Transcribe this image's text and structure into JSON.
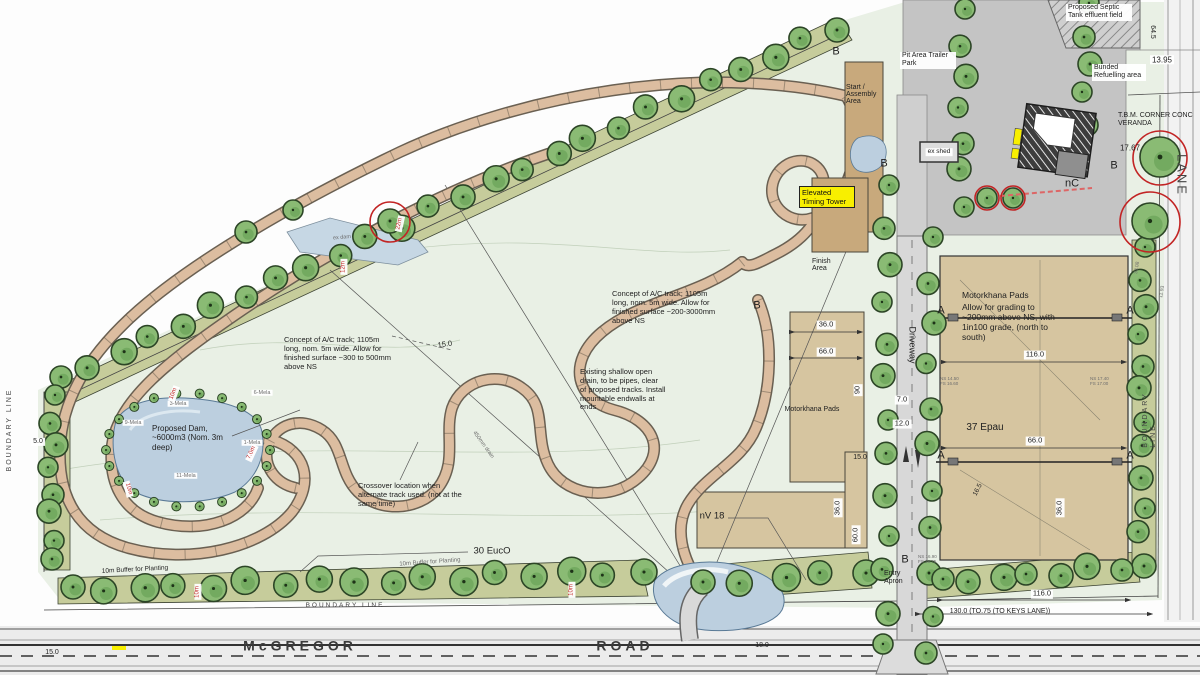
{
  "boxes": {
    "start": "Start / Assembly Area",
    "timing": "Elevated Timing Tower",
    "finish": "Finish Area"
  },
  "icons": {
    "tree": "green-scalloped-circle",
    "driveway_arrows": "up-down-flow-arrows"
  },
  "colors": {
    "site_green": "#e9f0e5",
    "buffer_olive": "#c6cc9b",
    "track_tan": "#dcbda0",
    "pad_tan": "#d6c5a0",
    "water_blue": "#bccfdf",
    "highlight_yellow": "#f8ef00",
    "markup_red": "#c22424"
  },
  "annotations": [
    {
      "n": "note-septic-tank",
      "t": "Proposed Septic Tank effluent field",
      "x": 1066,
      "y": 4,
      "fs": 7,
      "w": 62,
      "box": true
    },
    {
      "n": "note-bunded-refuelling",
      "t": "Bunded Refuelling area",
      "x": 1092,
      "y": 64,
      "fs": 7,
      "w": 50,
      "box": true
    },
    {
      "n": "note-pit-area",
      "t": "Pit Area Trailer Park",
      "x": 900,
      "y": 52,
      "fs": 7,
      "w": 52,
      "box": true
    },
    {
      "n": "note-tbm-corner",
      "t": "T.B.M. CORNER CONC VERANDA",
      "x": 1118,
      "y": 112,
      "fs": 7,
      "w": 80
    },
    {
      "n": "value-tbm-level",
      "t": "17.67",
      "x": 1130,
      "y": 148,
      "fs": 8
    },
    {
      "n": "dim-13-95",
      "t": "13.95",
      "x": 1162,
      "y": 60,
      "fs": 8,
      "box": true
    },
    {
      "n": "dim-64-5",
      "t": "64.5",
      "x": 1152,
      "y": 32,
      "fs": 7,
      "r": 90
    },
    {
      "n": "label-lane",
      "t": "LANE",
      "x": 1182,
      "y": 175,
      "fs": 13,
      "r": 90,
      "k": "sp"
    },
    {
      "n": "label-boundary-right",
      "t": "BOUNDARY LINE",
      "x": 1150,
      "y": 420,
      "fs": 7,
      "r": -90,
      "k": "sp"
    },
    {
      "n": "label-boundary-left",
      "t": "BOUNDARY LINE",
      "x": 10,
      "y": 430,
      "fs": 7,
      "r": -90,
      "k": "sp"
    },
    {
      "n": "label-boundary-bottom",
      "t": "BOUNDARY LINE",
      "x": 345,
      "y": 606,
      "fs": 6.5,
      "k": "sp"
    },
    {
      "n": "label-road-mcgregor",
      "t": "McGREGOR",
      "x": 300,
      "y": 646,
      "fs": 14,
      "k": "roadname"
    },
    {
      "n": "label-road-road",
      "t": "ROAD",
      "x": 625,
      "y": 646,
      "fs": 14,
      "k": "roadname"
    },
    {
      "n": "dim-15-0-road",
      "t": "15.0",
      "x": 52,
      "y": 653,
      "fs": 7
    },
    {
      "n": "dim-18-0",
      "t": "18.0",
      "x": 762,
      "y": 646,
      "fs": 7
    },
    {
      "n": "label-ex-shed",
      "t": "ex shed",
      "x": 939,
      "y": 152,
      "fs": 6.5,
      "box": true
    },
    {
      "n": "label-nc",
      "t": "nC",
      "x": 1072,
      "y": 184,
      "fs": 11
    },
    {
      "n": "section-marker-b-start",
      "t": "B",
      "x": 836,
      "y": 52,
      "fs": 11
    },
    {
      "n": "section-marker-b-track",
      "t": "B",
      "x": 757,
      "y": 306,
      "fs": 11
    },
    {
      "n": "section-marker-b-house",
      "t": "B",
      "x": 1114,
      "y": 166,
      "fs": 11
    },
    {
      "n": "section-marker-b-entry",
      "t": "B",
      "x": 905,
      "y": 560,
      "fs": 11
    },
    {
      "n": "section-marker-b-pond",
      "t": "B",
      "x": 884,
      "y": 164,
      "fs": 11
    },
    {
      "n": "section-marker-a1-left",
      "t": "A",
      "x": 941,
      "y": 311,
      "fs": 11
    },
    {
      "n": "section-marker-a1-right",
      "t": "A",
      "x": 1130,
      "y": 311,
      "fs": 11
    },
    {
      "n": "section-marker-a2-left",
      "t": "A",
      "x": 941,
      "y": 456,
      "fs": 11
    },
    {
      "n": "section-marker-a2-right",
      "t": "A",
      "x": 1130,
      "y": 456,
      "fs": 11
    },
    {
      "n": "note-concept-track-center",
      "t": "Concept of A/C track; 1105m long, nom. 5m wide. Allow for finished surface ~200-3000mm above NS",
      "x": 612,
      "y": 290,
      "fs": 7.5,
      "w": 112
    },
    {
      "n": "note-concept-track-left",
      "t": "Concept of A/C track; 1105m long, nom. 5m wide. Allow for finished surface ~300 to 500mm above NS",
      "x": 284,
      "y": 336,
      "fs": 7.5,
      "w": 108
    },
    {
      "n": "note-open-drain",
      "t": "Existing shallow open drain, to be pipes, clear of proposed tracks. Install mountable endwalls at ends",
      "x": 580,
      "y": 368,
      "fs": 7.5,
      "w": 86
    },
    {
      "n": "note-crossover",
      "t": "Crossover location when alternate track used. (not at the same time)",
      "x": 358,
      "y": 482,
      "fs": 7.5,
      "w": 104
    },
    {
      "n": "label-proposed-dam",
      "t": "Proposed Dam, ~6000m3 (Nom. 3m deep)",
      "x": 152,
      "y": 424,
      "fs": 8,
      "w": 82
    },
    {
      "n": "tag-3-mela",
      "t": "3-Mela",
      "x": 178,
      "y": 404,
      "fs": 5.5,
      "k": "grey box"
    },
    {
      "n": "tag-9-mela",
      "t": "9-Mela",
      "x": 133,
      "y": 423,
      "fs": 5.5,
      "k": "grey box"
    },
    {
      "n": "tag-6-mela",
      "t": "6-Mela",
      "x": 262,
      "y": 393,
      "fs": 5.5,
      "k": "grey box"
    },
    {
      "n": "tag-1-mela",
      "t": "1-Mela",
      "x": 252,
      "y": 443,
      "fs": 5.5,
      "k": "grey box"
    },
    {
      "n": "tag-11-mela",
      "t": "11-Mela",
      "x": 186,
      "y": 476,
      "fs": 5.5,
      "k": "grey box"
    },
    {
      "n": "label-motorkhana-center",
      "t": "Motorkhana Pads",
      "x": 812,
      "y": 410,
      "fs": 7,
      "k": "nowrap"
    },
    {
      "n": "dim-36-0-center",
      "t": "36.0",
      "x": 826,
      "y": 325,
      "fs": 7.5,
      "box": true
    },
    {
      "n": "dim-66-0-center",
      "t": "66.0",
      "x": 826,
      "y": 352,
      "fs": 7.5,
      "box": true
    },
    {
      "n": "dim-90-center",
      "t": "90",
      "x": 858,
      "y": 390,
      "fs": 7.5,
      "r": -90,
      "box": true
    },
    {
      "n": "dim-36-0-center-v",
      "t": "36.0",
      "x": 838,
      "y": 508,
      "fs": 7.5,
      "r": -90,
      "box": true
    },
    {
      "n": "dim-60-0-center-v",
      "t": "60.0",
      "x": 856,
      "y": 535,
      "fs": 7.5,
      "r": -90,
      "box": true
    },
    {
      "n": "label-nv18",
      "t": "nV 18",
      "x": 712,
      "y": 516,
      "fs": 9.5
    },
    {
      "n": "label-motorkhana-right",
      "t": "Motorkhana Pads",
      "x": 962,
      "y": 290,
      "fs": 8.5,
      "w": 90
    },
    {
      "n": "note-motorkhana-grading",
      "t": "Allow for grading to ~200mm above NS, with 1in100 grade, (north to south)",
      "x": 962,
      "y": 302,
      "fs": 8.5,
      "w": 100
    },
    {
      "n": "dim-116-0-right",
      "t": "116.0",
      "x": 1035,
      "y": 355,
      "fs": 7.5,
      "box": true
    },
    {
      "n": "dim-66-0-right",
      "t": "66.0",
      "x": 1035,
      "y": 441,
      "fs": 7.5,
      "box": true
    },
    {
      "n": "label-37-epau",
      "t": "37 Epau",
      "x": 985,
      "y": 428,
      "fs": 10
    },
    {
      "n": "dim-16-5",
      "t": "16.5",
      "x": 978,
      "y": 490,
      "fs": 6.5,
      "r": -62
    },
    {
      "n": "dim-36-0-right-v",
      "t": "36.0",
      "x": 1060,
      "y": 508,
      "fs": 7.5,
      "r": -90,
      "box": true
    },
    {
      "n": "spot-level-1",
      "t": "NS 14.50 FS 16.60",
      "x": 940,
      "y": 376,
      "fs": 4.5,
      "w": 20,
      "k": "grey"
    },
    {
      "n": "spot-level-2",
      "t": "NS 17.40 FS 17.00",
      "x": 1090,
      "y": 376,
      "fs": 4.5,
      "w": 20,
      "k": "grey"
    },
    {
      "n": "spot-level-3",
      "t": "NS 16.90 FS 16.75",
      "x": 918,
      "y": 554,
      "fs": 4.5,
      "w": 20,
      "k": "grey"
    },
    {
      "n": "label-driveway",
      "t": "Driveway",
      "x": 912,
      "y": 345,
      "fs": 9,
      "r": 90
    },
    {
      "n": "dim-7-0",
      "t": "7.0",
      "x": 902,
      "y": 400,
      "fs": 7.5,
      "box": true
    },
    {
      "n": "dim-12-0",
      "t": "12.0",
      "x": 902,
      "y": 424,
      "fs": 7.5,
      "box": true
    },
    {
      "n": "dim-15-0-driveway",
      "t": "15.0",
      "x": 860,
      "y": 458,
      "fs": 7
    },
    {
      "n": "dim-15-0-track",
      "t": "15.0",
      "x": 445,
      "y": 345,
      "fs": 7.5,
      "r": -8
    },
    {
      "n": "dim-5-0-left",
      "t": "5.0",
      "x": 38,
      "y": 442,
      "fs": 7,
      "box": true
    },
    {
      "n": "label-30-euco",
      "t": "30 EucO",
      "x": 492,
      "y": 551,
      "fs": 9.5
    },
    {
      "n": "label-buffer-planting-1",
      "t": "10m Buffer for Planting",
      "x": 135,
      "y": 570,
      "fs": 6.5,
      "r": -3,
      "k": "nowrap"
    },
    {
      "n": "label-buffer-planting-2",
      "t": "10m Buffer for Planting",
      "x": 430,
      "y": 563,
      "fs": 6,
      "r": -4,
      "k": "grey nowrap"
    },
    {
      "n": "dim-130-keys-lane",
      "t": "130.0 (TO.75 (TO KEYS LANE))",
      "x": 1000,
      "y": 612,
      "fs": 7,
      "k": "nowrap"
    },
    {
      "n": "dim-116-0-bottom",
      "t": "116.0",
      "x": 1042,
      "y": 594,
      "fs": 7.5,
      "box": true
    },
    {
      "n": "label-entry-apron",
      "t": "Entry Apron",
      "x": 884,
      "y": 570,
      "fs": 7,
      "w": 28
    },
    {
      "n": "redtick-10m-buffer-1",
      "t": "10m",
      "x": 198,
      "y": 592,
      "fs": 6,
      "r": -90,
      "k": "red box"
    },
    {
      "n": "redtick-10m-buffer-2",
      "t": "10m",
      "x": 572,
      "y": 590,
      "fs": 6,
      "r": -90,
      "k": "red box"
    },
    {
      "n": "redtick-10m-track-1",
      "t": "10m",
      "x": 174,
      "y": 394,
      "fs": 6,
      "r": -70,
      "k": "red box"
    },
    {
      "n": "redtick-7-0m-track",
      "t": "7.0m",
      "x": 252,
      "y": 453,
      "fs": 6,
      "r": -65,
      "k": "red box"
    },
    {
      "n": "redtick-10m-track-2",
      "t": "10m",
      "x": 128,
      "y": 489,
      "fs": 6,
      "r": 75,
      "k": "red box"
    },
    {
      "n": "redtick-12m",
      "t": "12m",
      "x": 344,
      "y": 267,
      "fs": 6,
      "r": -90,
      "k": "red box"
    },
    {
      "n": "redtick-22m",
      "t": "22m",
      "x": 400,
      "y": 224,
      "fs": 6,
      "r": -78,
      "k": "red box"
    },
    {
      "n": "label-ex-dam",
      "t": "ex dam",
      "x": 342,
      "y": 238,
      "fs": 5.5,
      "r": -5,
      "k": "grey"
    },
    {
      "n": "label-450mm-drain",
      "t": "450mm drain",
      "x": 483,
      "y": 445,
      "fs": 5.5,
      "r": 54,
      "k": "grey nowrap"
    },
    {
      "n": "dim-33-08",
      "t": "33.08",
      "x": 1138,
      "y": 268,
      "fs": 5,
      "r": -80,
      "k": "grey"
    },
    {
      "n": "dim-11-93",
      "t": "11.93",
      "x": 1163,
      "y": 292,
      "fs": 5,
      "r": -80,
      "k": "grey"
    }
  ]
}
